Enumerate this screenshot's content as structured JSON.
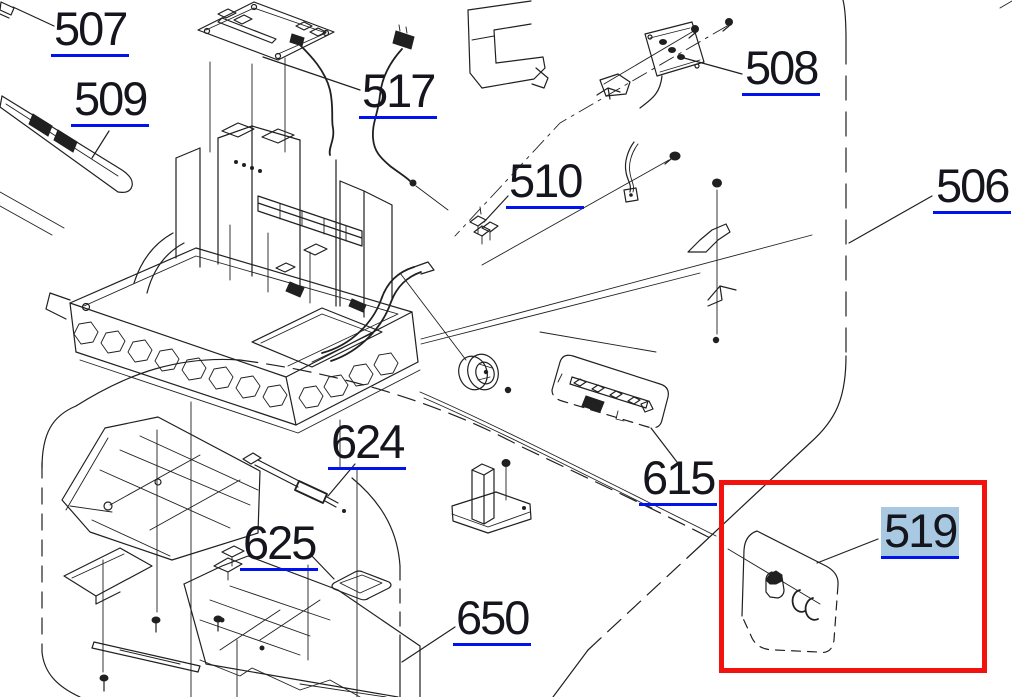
{
  "diagram": {
    "type": "exploded-parts-diagram",
    "labels": {
      "507": "507",
      "509": "509",
      "517": "517",
      "510": "510",
      "508": "508",
      "506": "506",
      "624": "624",
      "625": "625",
      "615": "615",
      "650": "650",
      "519": "519"
    },
    "selected_part": "519",
    "colors": {
      "link_underline": "#0013ee",
      "selection_highlight": "#a9c9e3",
      "attention_box": "#f2120e",
      "line_art": "#202020",
      "background": "#ffffff"
    }
  }
}
